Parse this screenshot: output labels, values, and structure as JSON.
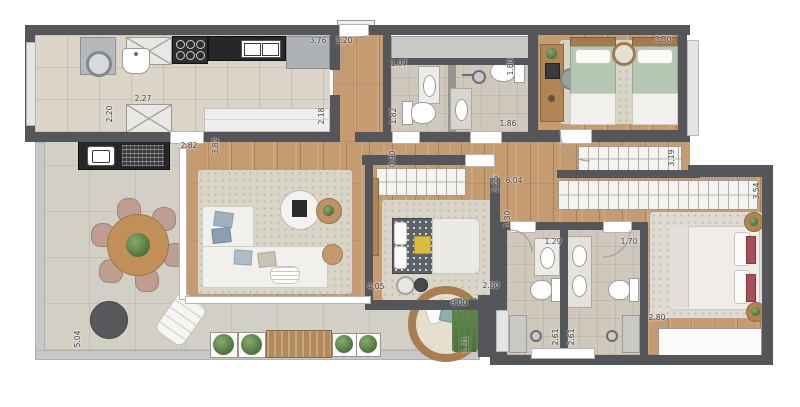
{
  "plan": {
    "colors": {
      "wall": "#55565a",
      "wood": "#c59c72",
      "tile": "#dad5c8",
      "bath_tile": "#cfc9bd",
      "terrace": "#d2cfc5",
      "rug": "#d9d5c8",
      "window": "#e3e4e6",
      "counter_black": "#27272a",
      "wood_furniture": "#b08455",
      "bed_green": "#b5c6b2",
      "accent_red": "#a84f58",
      "accent_yellow": "#d9bd3f",
      "plant_green": "#537a45",
      "label": "#3e3e41"
    },
    "dimensions": [
      {
        "label": "3.76",
        "x": 318,
        "y": 41,
        "o": "h"
      },
      {
        "label": "1.20",
        "x": 344,
        "y": 41,
        "o": "h"
      },
      {
        "label": "2.27",
        "x": 143,
        "y": 99,
        "o": "h"
      },
      {
        "label": "2.20",
        "x": 110,
        "y": 114,
        "o": "v"
      },
      {
        "label": "2.18",
        "x": 322,
        "y": 116,
        "o": "v"
      },
      {
        "label": "1.07",
        "x": 399,
        "y": 64,
        "o": "h"
      },
      {
        "label": "1.82",
        "x": 394,
        "y": 116,
        "o": "v"
      },
      {
        "label": "1.80",
        "x": 511,
        "y": 67,
        "o": "v"
      },
      {
        "label": "1.86",
        "x": 508,
        "y": 124,
        "o": "h"
      },
      {
        "label": "3.30",
        "x": 663,
        "y": 40,
        "o": "h"
      },
      {
        "label": "2.82",
        "x": 189,
        "y": 146,
        "o": "h"
      },
      {
        "label": "3.82",
        "x": 216,
        "y": 146,
        "o": "v"
      },
      {
        "label": "0.90",
        "x": 393,
        "y": 159,
        "o": "v"
      },
      {
        "label": "2.65",
        "x": 496,
        "y": 184,
        "o": "v"
      },
      {
        "label": "6.04",
        "x": 514,
        "y": 181,
        "o": "h"
      },
      {
        "label": "3.19",
        "x": 672,
        "y": 158,
        "o": "v"
      },
      {
        "label": "3.54",
        "x": 757,
        "y": 191,
        "o": "v"
      },
      {
        "label": "1.30",
        "x": 508,
        "y": 219,
        "o": "v"
      },
      {
        "label": "1.29",
        "x": 553,
        "y": 242,
        "o": "h"
      },
      {
        "label": "1.70",
        "x": 629,
        "y": 242,
        "o": "h"
      },
      {
        "label": "4.05",
        "x": 376,
        "y": 287,
        "o": "h"
      },
      {
        "label": "2.80",
        "x": 491,
        "y": 286,
        "o": "h"
      },
      {
        "label": "2.80",
        "x": 657,
        "y": 318,
        "o": "h"
      },
      {
        "label": "2.61",
        "x": 556,
        "y": 337,
        "o": "v"
      },
      {
        "label": "2.61",
        "x": 572,
        "y": 337,
        "o": "v"
      },
      {
        "label": "5.04",
        "x": 78,
        "y": 339,
        "o": "v"
      },
      {
        "label": "9.00",
        "x": 459,
        "y": 303,
        "o": "h"
      },
      {
        "label": "1.31",
        "x": 466,
        "y": 345,
        "o": "v"
      }
    ]
  }
}
